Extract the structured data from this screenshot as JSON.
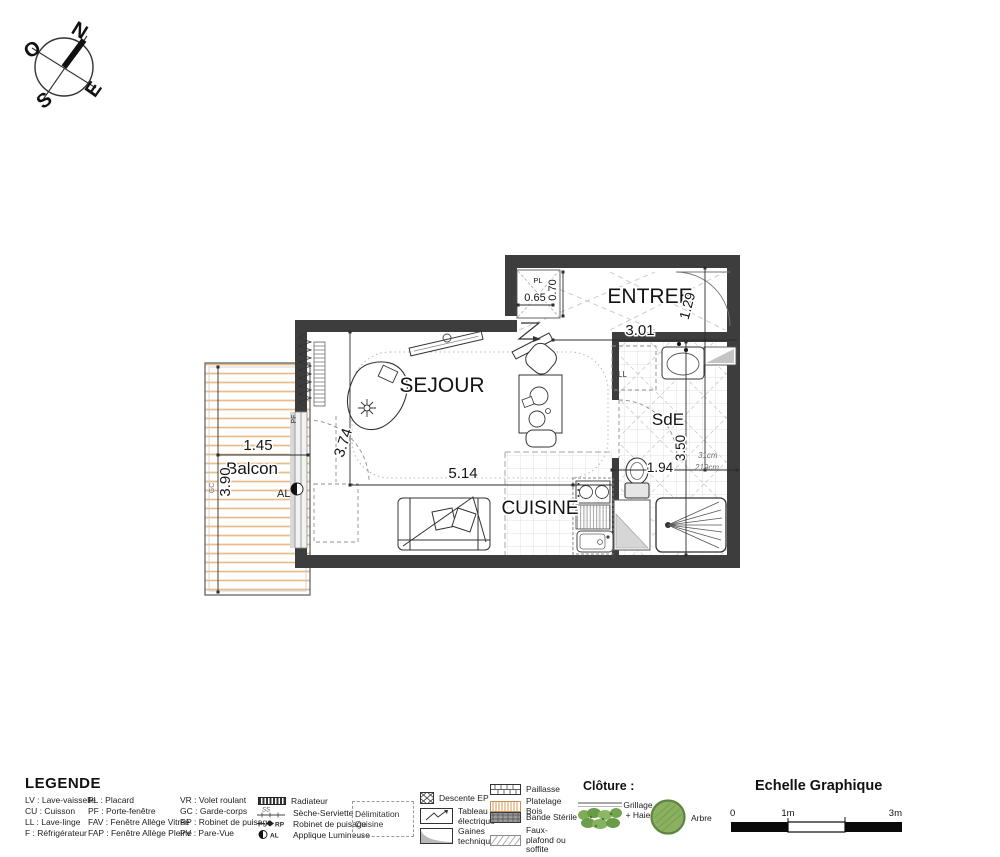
{
  "compass": {
    "n": "N",
    "o": "O",
    "e": "E",
    "s": "S"
  },
  "plan": {
    "rooms": {
      "sejour": "SEJOUR",
      "entree": "ENTREE",
      "cuisine": "CUISINE",
      "sde": "SdE",
      "balcon": "Balcon",
      "placard": "PL"
    },
    "dims": {
      "balcon_w": "1.45",
      "balcon_d": "3.90",
      "sejour_w": "5.14",
      "sejour_d": "3.74",
      "entree_w": "3.01",
      "entree_d": "1.29",
      "pl_w": "0.65",
      "pl_d": "0.70",
      "sde_w": "1.94",
      "sde_d": "3.50",
      "soffite_w": "31cm",
      "soffite_h": "219cm"
    },
    "tags": {
      "gc": "GC",
      "al": "AL",
      "pf": "PF",
      "ll": "LL"
    }
  },
  "legend": {
    "title": "LEGENDE",
    "col1": [
      "LV : Lave-vaisselle",
      "CU : Cuisson",
      "LL : Lave-linge",
      "F : Réfrigérateur"
    ],
    "col2": [
      "PL : Placard",
      "PF : Porte-fenêtre",
      "FAV : Fenêtre Allège Vitrée",
      "FAP : Fenêtre Allège Pleine"
    ],
    "col3": [
      "VR : Volet roulant",
      "GC : Garde-corps",
      "RP : Robinet de puisage",
      "PV : Pare-Vue"
    ],
    "symbols": {
      "radiateur": "Radiateur",
      "seche_serviette": "Sèche-Serviette",
      "robinet": "Robinet de puisage",
      "applique": "Applique Lumineuse",
      "ss": "SS",
      "rp": "RP",
      "al": "AL"
    },
    "delimitation": "Délimitation Cuisine",
    "boxes": {
      "descente": "Descente EP",
      "tableau": "Tableau électrique",
      "gaines": "Gaines techniques"
    },
    "swatches": {
      "paillasse": "Paillasse",
      "platelage": "Platelage Bois",
      "bande": "Bande Stérile",
      "faux_plafond": "Faux-plafond ou soffite"
    },
    "cloture": {
      "title": "Clôture :",
      "grillage": "Grillage + Haie",
      "arbre": "Arbre"
    }
  },
  "scale": {
    "title": "Echelle Graphique",
    "t0": "0",
    "t1": "1m",
    "t3": "3m"
  }
}
